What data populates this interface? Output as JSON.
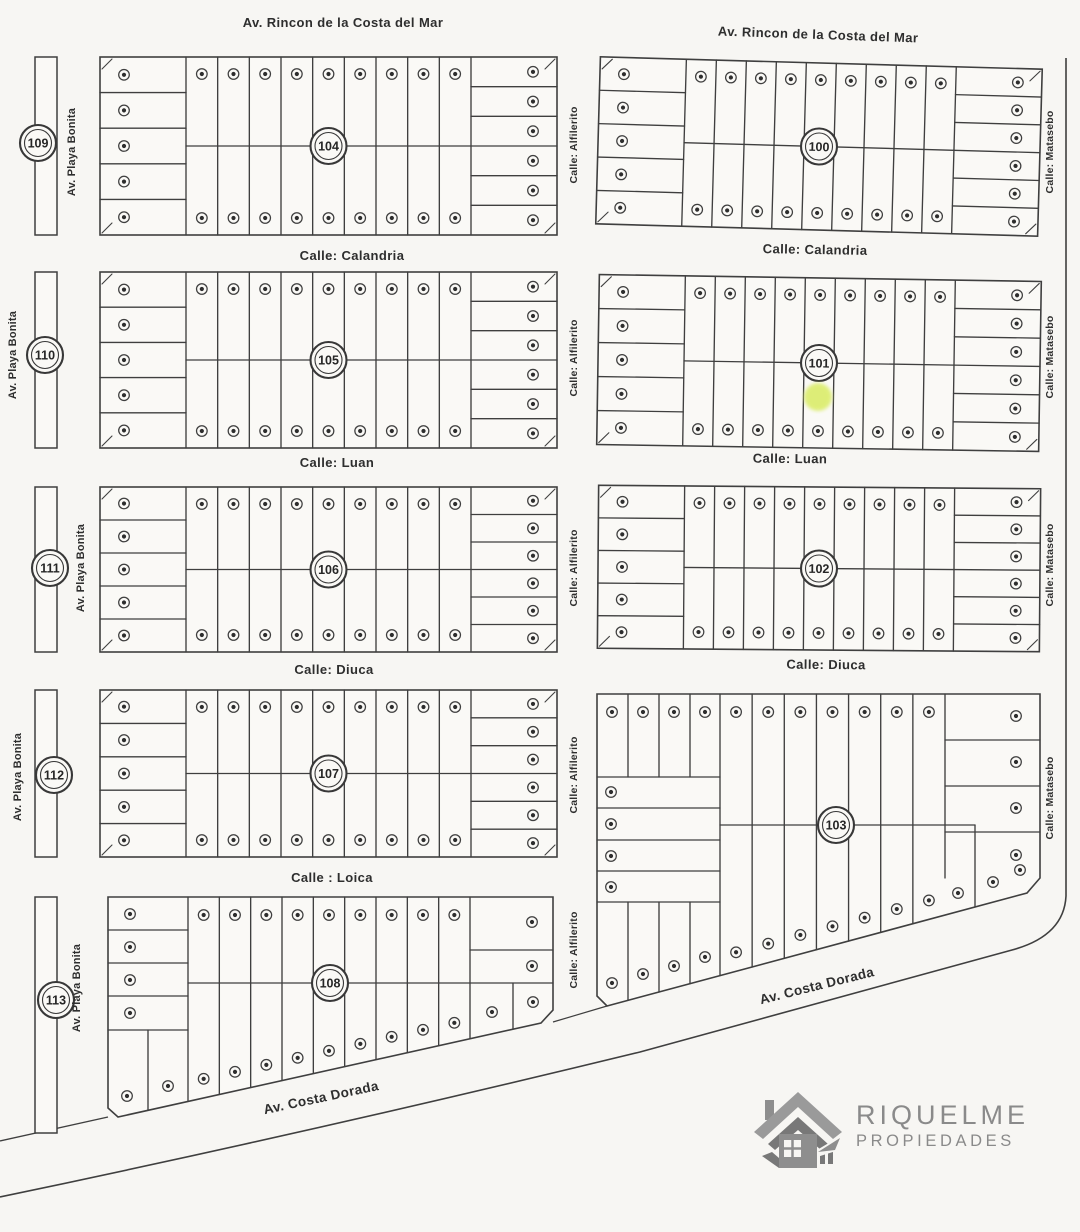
{
  "map": {
    "streets": {
      "rincon": "Av. Rincon de la Costa del Mar",
      "calandria": "Calle: Calandria",
      "luan": "Calle: Luan",
      "diuca": "Calle: Diuca",
      "loica": "Calle : Loica",
      "costa_dorada": "Av. Costa Dorada",
      "playa_bonita": "Av. Playa Bonita",
      "alfilerito": "Calle: Alfilerito",
      "matasebo": "Calle: Matasebo"
    },
    "strip_blocks": [
      "109",
      "110",
      "111",
      "112",
      "113"
    ],
    "standard_blocks": [
      {
        "number": "104",
        "lots": {
          "left": 5,
          "middle_top": 9,
          "middle_bottom": 9,
          "right": 6
        }
      },
      {
        "number": "105",
        "lots": {
          "left": 5,
          "middle_top": 9,
          "middle_bottom": 9,
          "right": 6
        }
      },
      {
        "number": "106",
        "lots": {
          "left": 5,
          "middle_top": 9,
          "middle_bottom": 9,
          "right": 6
        }
      },
      {
        "number": "107",
        "lots": {
          "left": 5,
          "middle_top": 9,
          "middle_bottom": 9,
          "right": 6
        }
      },
      {
        "number": "100",
        "lots": {
          "left": 5,
          "middle_top": 9,
          "middle_bottom": 9,
          "right": 6
        }
      },
      {
        "number": "101",
        "lots": {
          "left": 5,
          "middle_top": 9,
          "middle_bottom": 9,
          "right": 6
        }
      },
      {
        "number": "102",
        "lots": {
          "left": 5,
          "middle_top": 9,
          "middle_bottom": 9,
          "right": 6
        }
      }
    ],
    "irregular_blocks": [
      {
        "number": "108",
        "lots": {
          "left": 4,
          "bottom_left": 2,
          "middle_top": 9,
          "middle_bottom": 9,
          "right": 4
        }
      },
      {
        "number": "103",
        "lots": {
          "top": 11,
          "left": 4,
          "bottom_left": 4,
          "middle_bottom": 7,
          "right": 7
        }
      }
    ],
    "highlight": {
      "block": "101",
      "color": "#d9ec62"
    }
  },
  "logo": {
    "name": "RIQUELME",
    "tagline": "PROPIEDADES"
  }
}
